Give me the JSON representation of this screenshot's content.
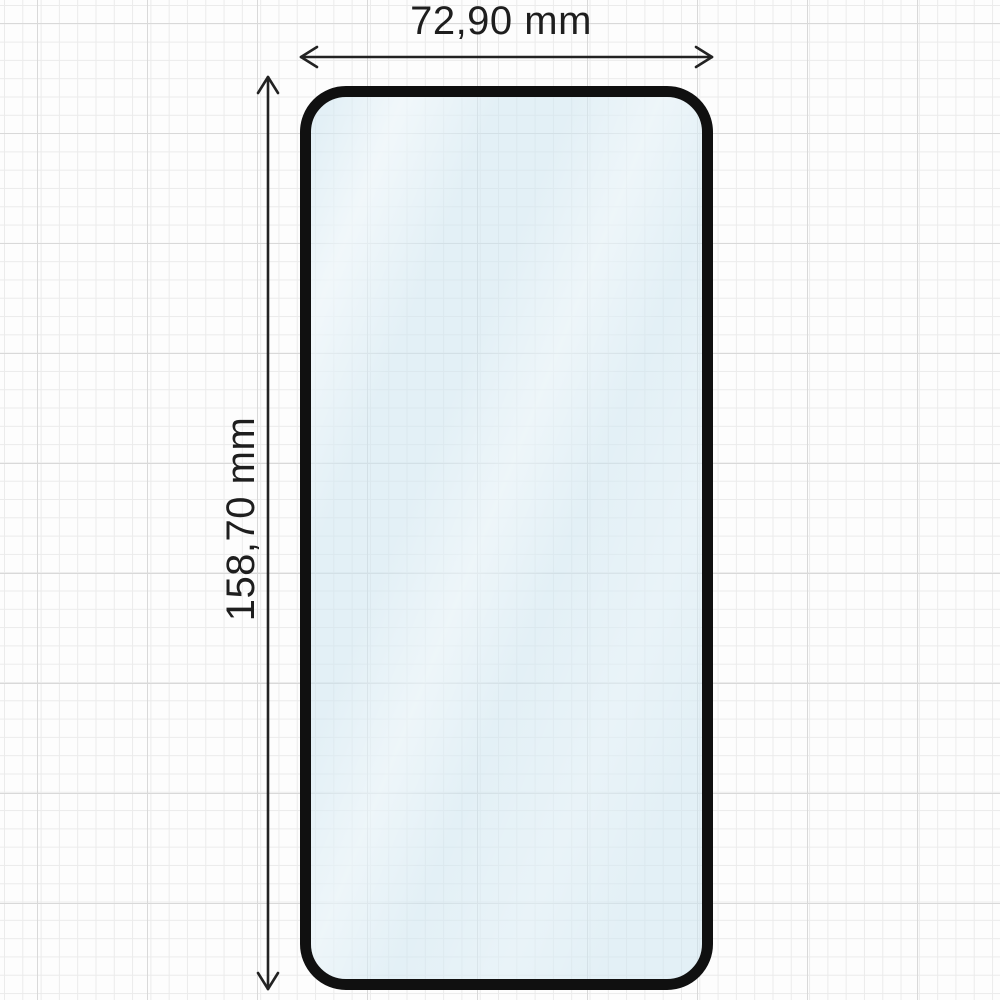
{
  "diagram": {
    "type": "screen-protector-dimension-drawing",
    "width_label": "72,90 mm",
    "height_label": "158,70 mm"
  },
  "colors": {
    "background": "#fdfdfd",
    "grid-minor": "#ebebeb",
    "grid-major": "#d9d9d9",
    "outline": "#101010",
    "glass-tint": "#cee5f1",
    "arrow": "#222222",
    "text": "#1e1e1e"
  }
}
